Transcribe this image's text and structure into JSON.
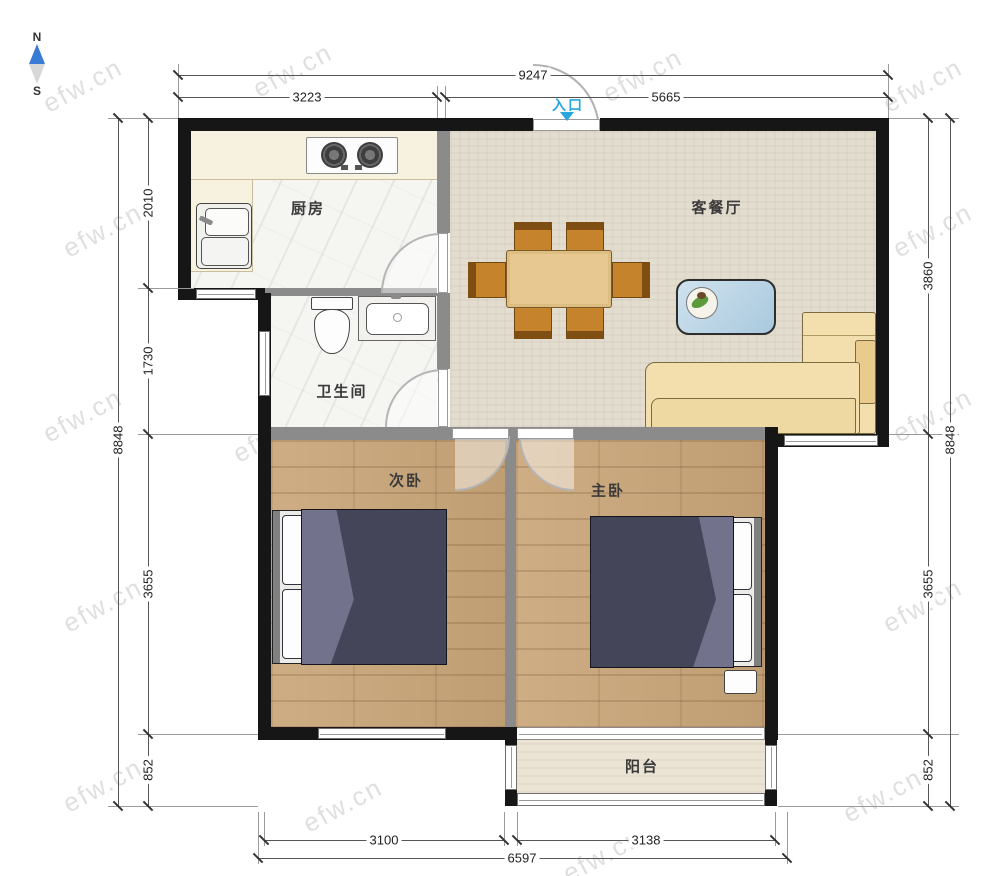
{
  "title": "两室一厅户型图",
  "watermark": "efw.cn",
  "compass": {
    "north": "N",
    "south": "S"
  },
  "entrance": {
    "label": "入口"
  },
  "rooms": {
    "kitchen": {
      "label": "厨房"
    },
    "living_dining": {
      "label": "客餐厅"
    },
    "bathroom": {
      "label": "卫生间"
    },
    "second_bedroom": {
      "label": "次卧"
    },
    "master_bedroom": {
      "label": "主卧"
    },
    "balcony": {
      "label": "阳台"
    }
  },
  "dimensions_mm": {
    "top": {
      "total": "9247",
      "segments": [
        "3223",
        "5665"
      ]
    },
    "left": {
      "total": "8848",
      "segments": [
        "2010",
        "1730",
        "3655",
        "852"
      ]
    },
    "right": {
      "total": "8848",
      "segments": [
        "3860",
        "3655",
        "852"
      ]
    },
    "bottom": {
      "total": "6597",
      "segments": [
        "3100",
        "3138"
      ]
    }
  },
  "colors": {
    "wall": "#161616",
    "partition": "#8b8b8b",
    "wood_floor": "#c7a57b",
    "living_floor": "#e3ddd0",
    "tile_floor": "#f5f5f2",
    "sofa": "#f3dfae",
    "bed_cover": "#45455a",
    "accent_entrance": "#29a6df",
    "table_wood": "#c5832c",
    "coffee_table": "#b9d6e9"
  }
}
